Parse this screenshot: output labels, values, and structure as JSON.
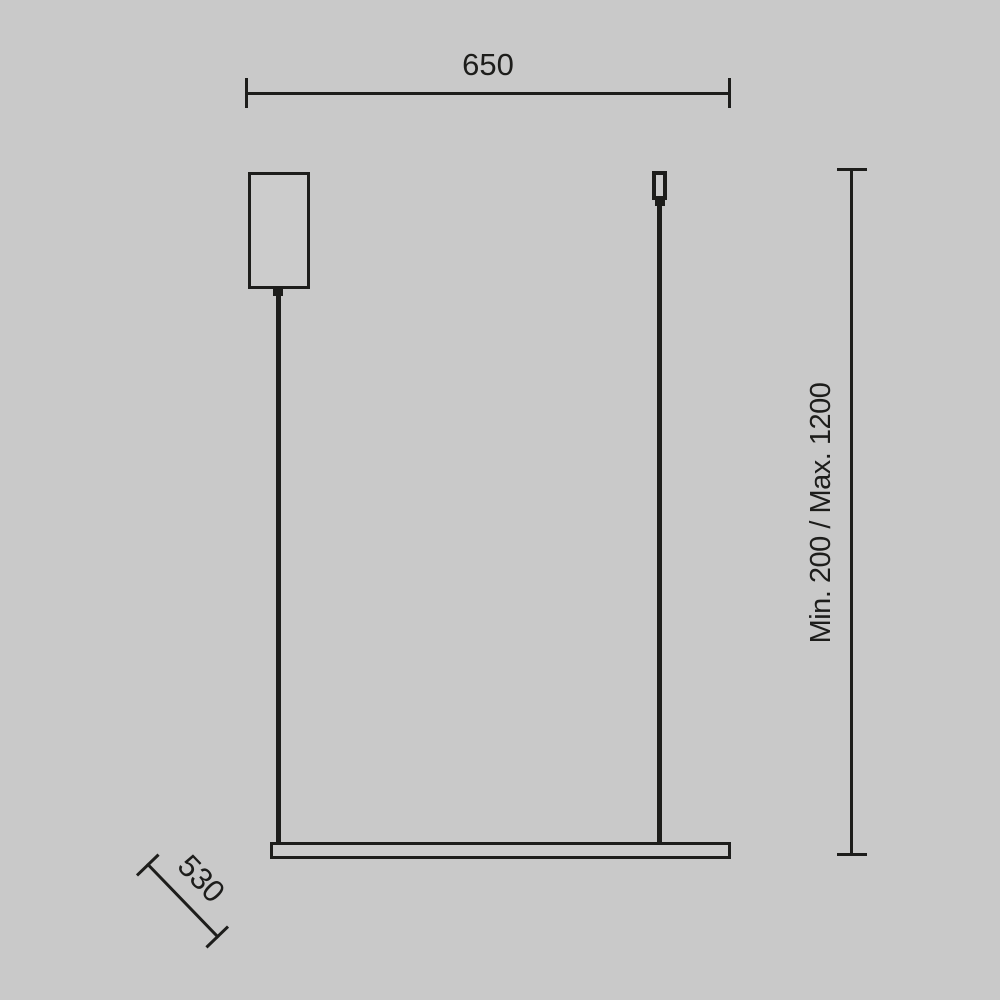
{
  "colors": {
    "background": "#c9c9c9",
    "line": "#1d1d1b",
    "shape_fill": "#cccccc"
  },
  "dimensions": {
    "width": {
      "label": "650"
    },
    "height": {
      "label": "Min. 200 / Max. 1200"
    },
    "depth": {
      "label": "530"
    }
  }
}
